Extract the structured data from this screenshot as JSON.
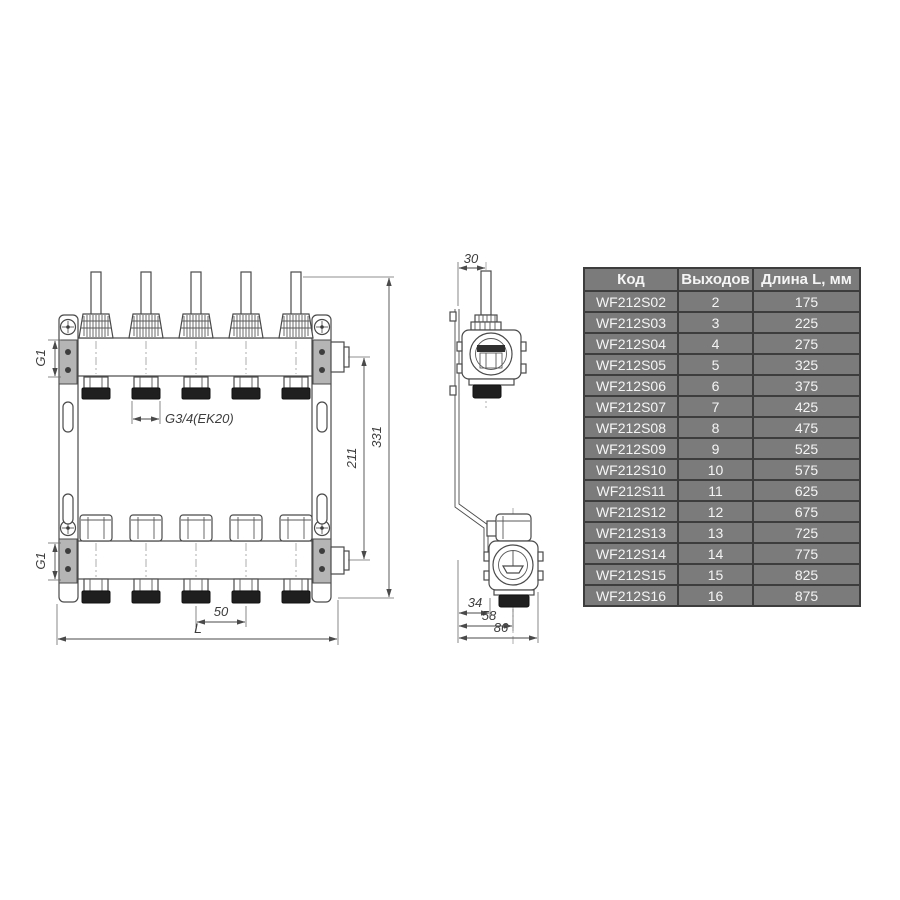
{
  "drawing": {
    "front_view": {
      "g1_top": "G1",
      "g1_bottom": "G1",
      "outlet_thread": "G3/4(EK20)",
      "outlet_spacing": "50",
      "length": "L",
      "outlet_center_height": "211",
      "total_height": "331"
    },
    "side_view": {
      "stem_offset": "30",
      "bracket_depth": "34",
      "axis_depth": "58",
      "total_depth": "86"
    },
    "line_color": "#4a4a4a"
  },
  "table": {
    "headers": [
      "Код",
      "Выходов",
      "Длина L, мм"
    ],
    "colors": {
      "cell_bg": "#7b7b7b",
      "border": "#3d3d3d",
      "text": "#f5f5f5"
    },
    "rows": [
      {
        "code": "WF212S02",
        "outputs": "2",
        "length": "175"
      },
      {
        "code": "WF212S03",
        "outputs": "3",
        "length": "225"
      },
      {
        "code": "WF212S04",
        "outputs": "4",
        "length": "275"
      },
      {
        "code": "WF212S05",
        "outputs": "5",
        "length": "325"
      },
      {
        "code": "WF212S06",
        "outputs": "6",
        "length": "375"
      },
      {
        "code": "WF212S07",
        "outputs": "7",
        "length": "425"
      },
      {
        "code": "WF212S08",
        "outputs": "8",
        "length": "475"
      },
      {
        "code": "WF212S09",
        "outputs": "9",
        "length": "525"
      },
      {
        "code": "WF212S10",
        "outputs": "10",
        "length": "575"
      },
      {
        "code": "WF212S11",
        "outputs": "11",
        "length": "625"
      },
      {
        "code": "WF212S12",
        "outputs": "12",
        "length": "675"
      },
      {
        "code": "WF212S13",
        "outputs": "13",
        "length": "725"
      },
      {
        "code": "WF212S14",
        "outputs": "14",
        "length": "775"
      },
      {
        "code": "WF212S15",
        "outputs": "15",
        "length": "825"
      },
      {
        "code": "WF212S16",
        "outputs": "16",
        "length": "875"
      }
    ]
  }
}
